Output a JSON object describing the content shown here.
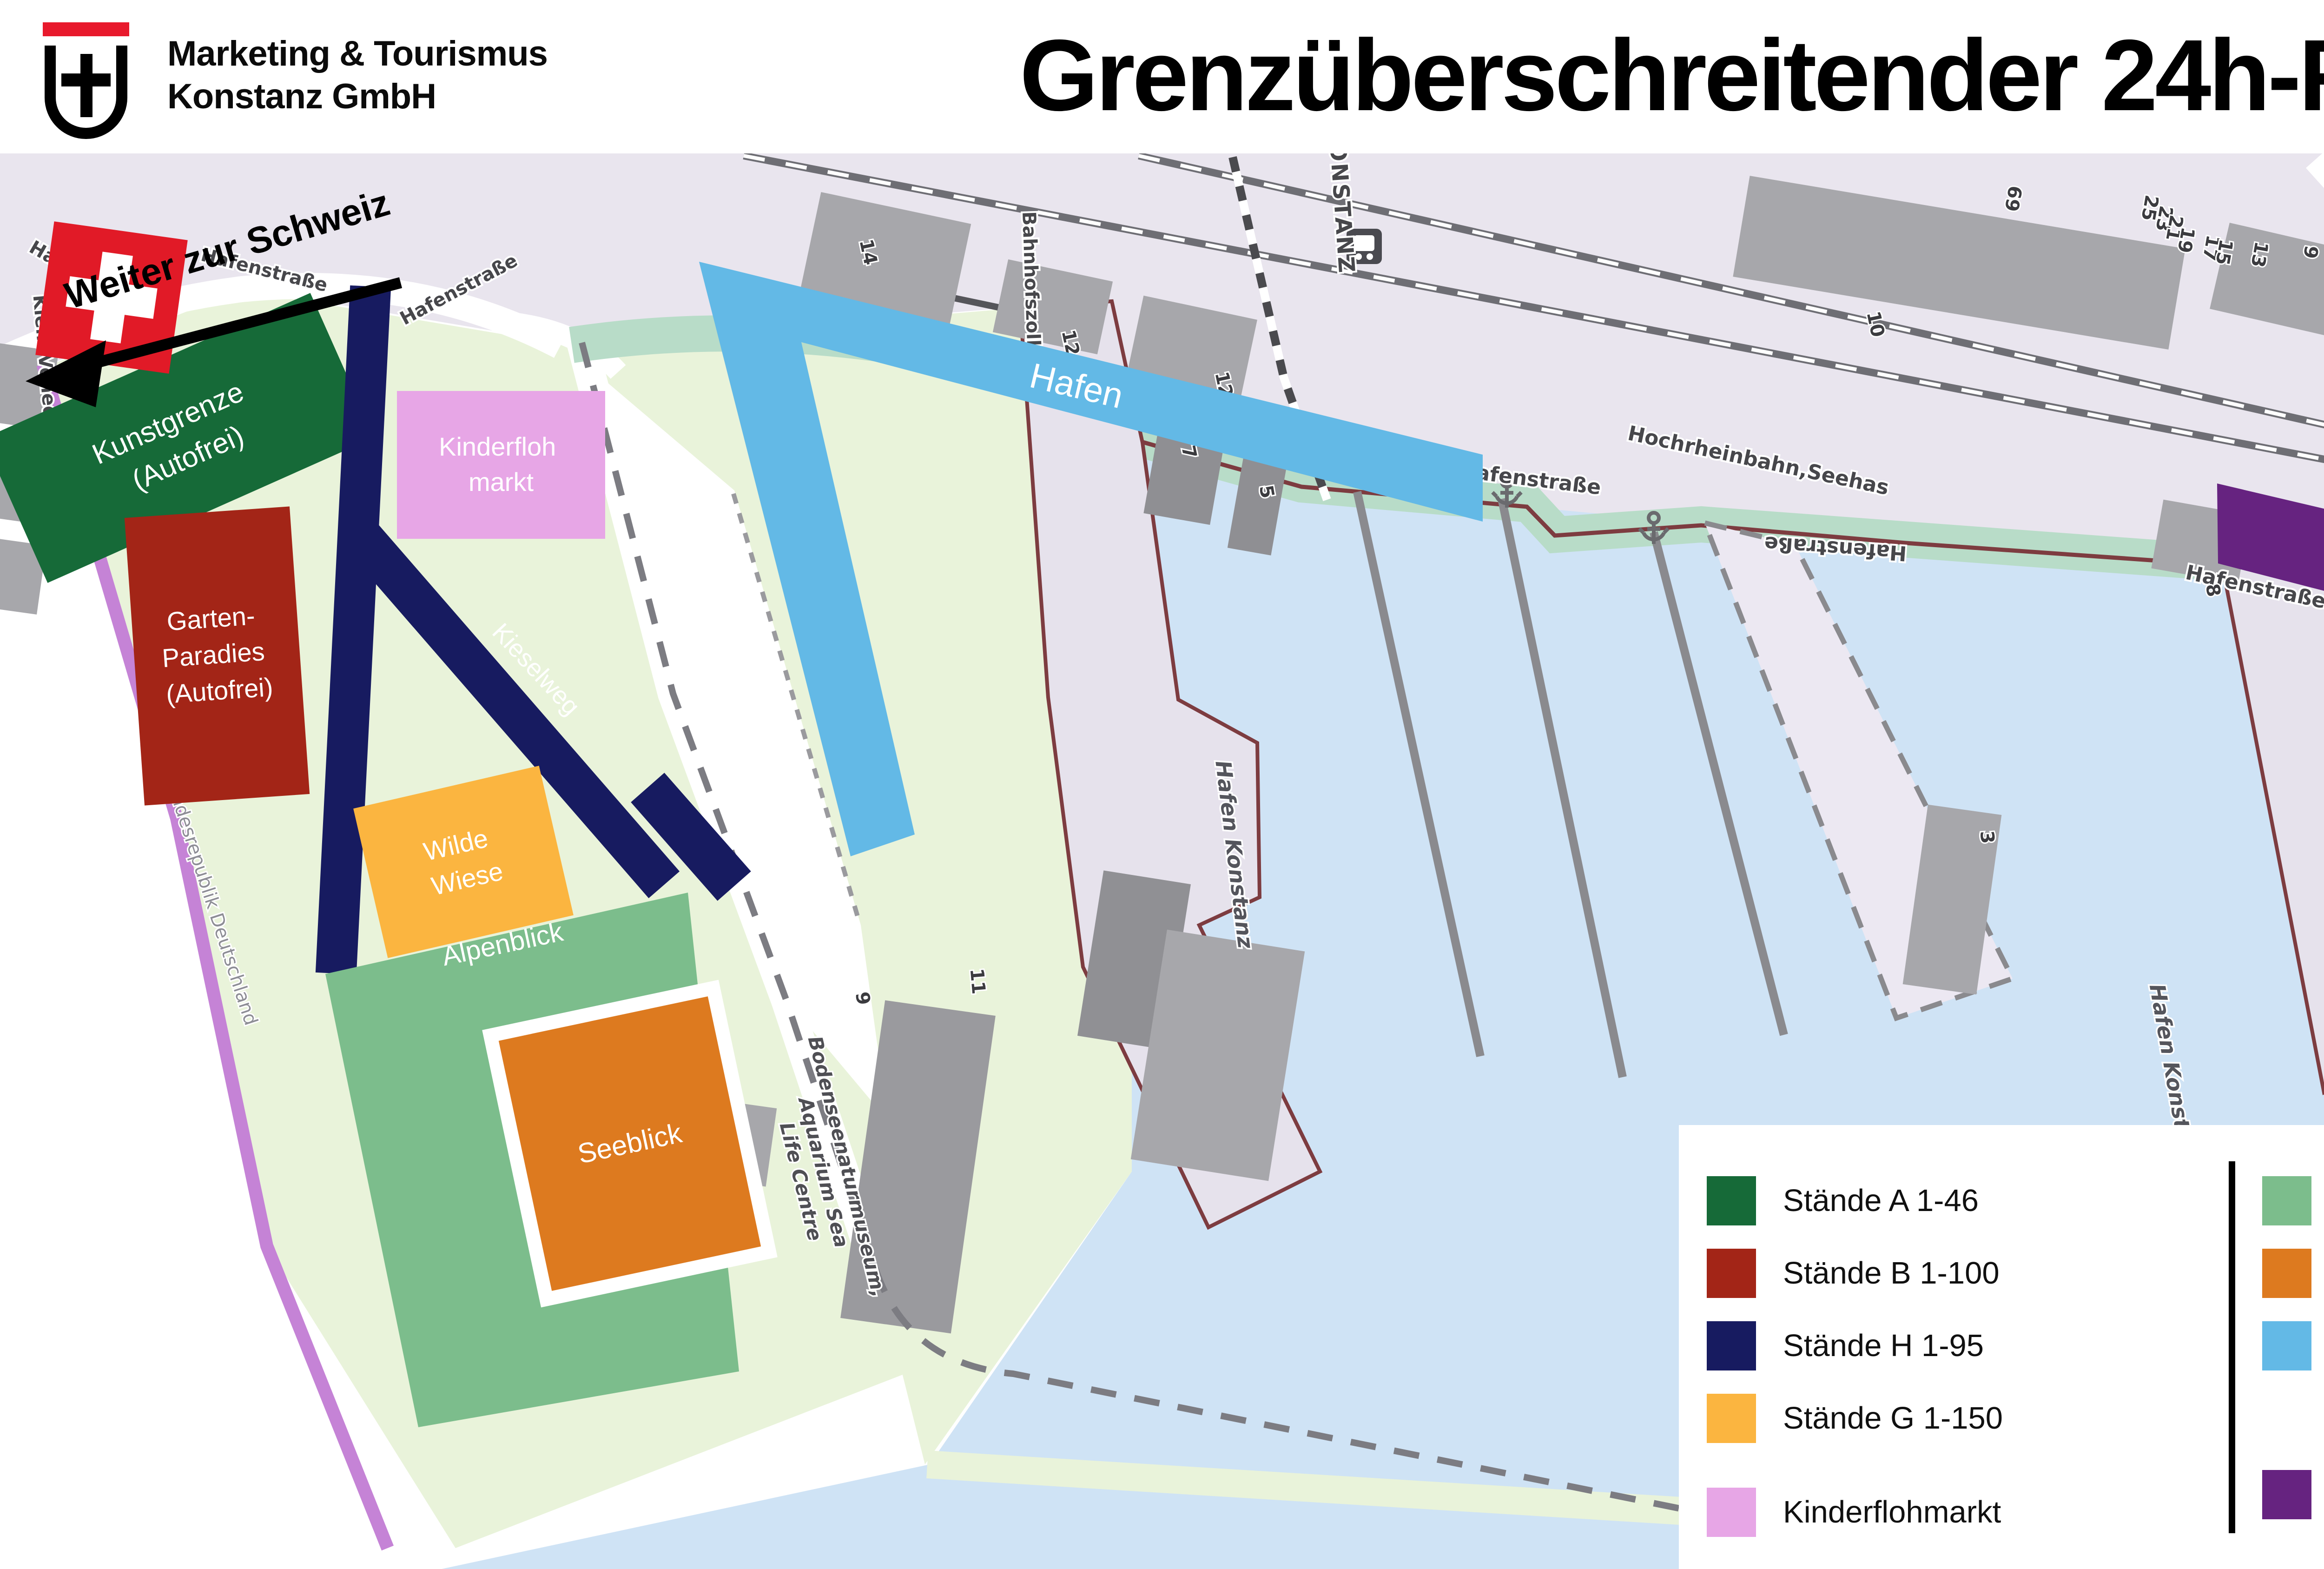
{
  "header": {
    "logo_line1": "Marketing & Tourismus",
    "logo_line2": "Konstanz GmbH",
    "title": "Grenzüberschreitender 24h-Flohmarkt"
  },
  "map": {
    "direction_note": "Weiter zur Schweiz",
    "zones": {
      "kunstgrenze": {
        "lines": [
          "Kunstgrenze",
          "(Autofrei)"
        ],
        "color": "#166a38"
      },
      "garten": {
        "lines": [
          "Garten-",
          "Paradies",
          "(Autofrei)"
        ],
        "color": "#a32517"
      },
      "staende_h": {
        "label": "Kieselweg",
        "color": "#171b60"
      },
      "wilde_wiese": {
        "lines": [
          "Wilde",
          "Wiese"
        ],
        "color": "#fbb540"
      },
      "alpenblick": {
        "label": "Alpenblick",
        "color": "#7cbd8c"
      },
      "seeblick": {
        "label": "Seeblick",
        "color": "#dd7a1f"
      },
      "kinderfloh": {
        "lines": [
          "Kinderfloh",
          "markt"
        ],
        "color": "#e7a6e6"
      },
      "kunstmarkt": {
        "label": "Hafen",
        "color": "#63b9e6"
      },
      "imperia": {
        "label": "Imperia",
        "color": "#662380"
      }
    },
    "streets": {
      "hafenstrasse": "Hafenstraße",
      "marktstaette": "Marktstätte",
      "hochrheinbahn": "Hochrheinbahn,Seehas",
      "konzil": "Konzil",
      "bahnhofszoll": "Bahnhofszoll",
      "klein_venedig": "Klein Venedig",
      "grenzuebergang": "Grenzübergang",
      "bundesrepublik": "Bundesrepublik Deutschland",
      "station": "KONSTANZ"
    },
    "water_labels": {
      "hafen_konstanz": "Hafen Konstanz",
      "konstanz": "Konstanz",
      "konstanz_hafen": "Konstanz Hafen"
    },
    "poi": {
      "museum_lines": [
        "Bodenseenaturmuseum,",
        "Aquarium Sea",
        "Life Centre"
      ]
    },
    "building_numbers": [
      "23",
      "14",
      "12",
      "12",
      "11a",
      "7",
      "5",
      "10",
      "8",
      "2",
      "4d",
      "2",
      "1a",
      "3",
      "1",
      "9",
      "7",
      "3",
      "11",
      "9",
      "69",
      "25",
      "23",
      "21",
      "19",
      "17",
      "15",
      "13"
    ]
  },
  "legend": {
    "left": [
      {
        "label": "Stände A 1-46",
        "color": "#166a38"
      },
      {
        "label": "Stände B 1-100",
        "color": "#a32517"
      },
      {
        "label": "Stände H 1-95",
        "color": "#171b60"
      },
      {
        "label": "Stände G 1-150",
        "color": "#fbb540"
      },
      {
        "label": "Kinderflohmarkt",
        "color": "#e7a6e6"
      }
    ],
    "right": [
      {
        "label": "Stände D 1-98",
        "color": "#7cbd8c"
      },
      {
        "label": "Stände E 1-127",
        "color": "#dd7a1f"
      },
      {
        "lines": [
          "Kunst- &",
          "Kreativhandwerkermarkt",
          "+ Stände I 1-57"
        ],
        "color": "#63b9e6"
      },
      {
        "label": "Stände J 1-55",
        "color": "#662380"
      }
    ]
  }
}
